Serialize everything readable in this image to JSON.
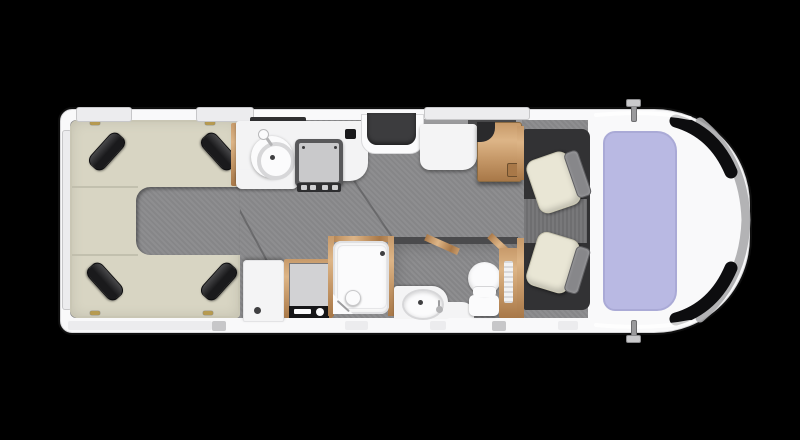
{
  "title": "motorhome-floorplan",
  "colors": {
    "bg": "#000000",
    "body": "#f9f9fa",
    "bodyEdge": "#d8d8da",
    "floor": "#8a8a8c",
    "floorSeam": "#505052",
    "loungeCream": "#d8d5c3",
    "loungeEdge": "#c9c6b4",
    "loungeSeam": "#bdbaa9",
    "cushion": "#1a1a1c",
    "cushionHi": "#48484a",
    "gold": "#b2923f",
    "windowFrame": "#ececee",
    "windowFrameEdge": "#c7c7c9",
    "windowSlit": "#2f2f31",
    "sillGray": "#9b9b9d",
    "counter": "#f3f3f4",
    "counterEdge": "#d7d7d9",
    "white": "#fbfbfc",
    "drain": "#3f3f41",
    "hobFrame": "#58585a",
    "hobPanel": "#c9c9cb",
    "hobKnobStrip": "#2e2e30",
    "knobLight": "#cfcfd1",
    "socket": "#19191b",
    "doorRecess": "#3c3c3e",
    "stepWhite": "#f4f4f5",
    "wood": "#c79a6a",
    "woodHi": "#ddb587",
    "woodDark": "#a87848",
    "woodEdge": "#8a6a42",
    "notchDark": "#2a2a2c",
    "applianceGray": "#d2d2d4",
    "applianceDark": "#161618",
    "bathWall": "#4a4a4c",
    "ventWhite": "#f2f2f3",
    "cabFloor": "#323234",
    "cabWalkway": "#737375",
    "seatCream": "#e9e6d5",
    "seatFrame": "#87878a",
    "windscreen": "#b9b9e3",
    "windscreenEdge": "#aaaad6",
    "blackTrim": "#0d0d0f",
    "bumperGray": "#ababad"
  },
  "fixtures": [
    "rear-u-lounge",
    "scatter-cushions",
    "kitchen-sink",
    "kitchen-hob",
    "entry-door",
    "sideboard",
    "wooden-table",
    "storage-cabinet",
    "fridge",
    "shower-cubicle",
    "shower-head",
    "washroom-basin",
    "toilet",
    "washroom-cabinet",
    "driver-swivel-seat",
    "passenger-swivel-seat",
    "windscreen",
    "side-mirrors"
  ]
}
